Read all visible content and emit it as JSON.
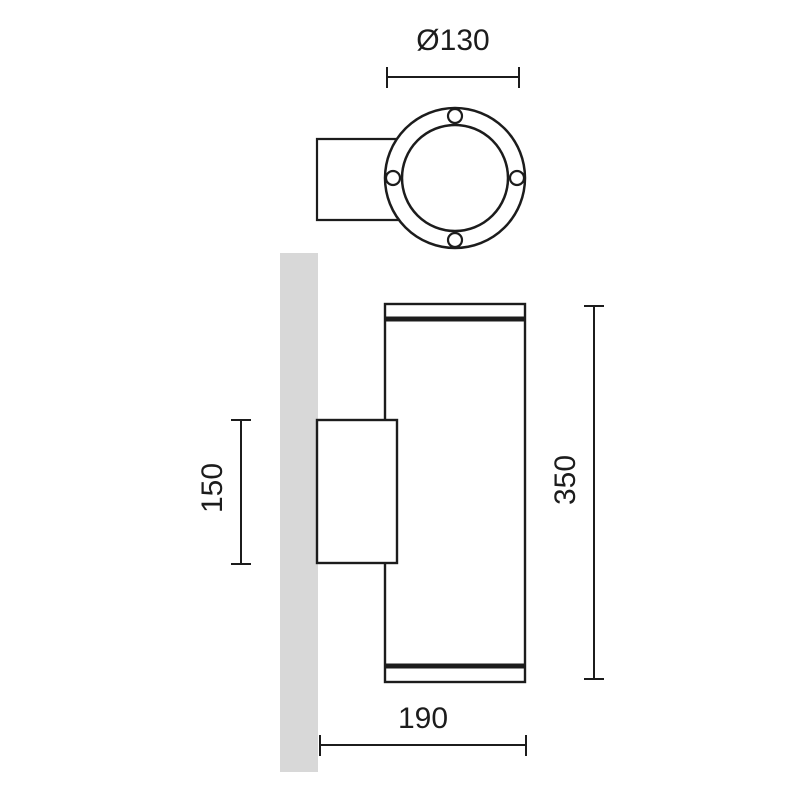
{
  "dimensions": {
    "flange_diameter": "Ø130",
    "bracket_height": "150",
    "body_height": "350",
    "body_depth": "190"
  },
  "views": {
    "top_view": {
      "screw_hole_count": 4
    },
    "front_view": {
      "parts": [
        "wall",
        "mounting-bracket",
        "cylindrical-body"
      ]
    }
  },
  "colors": {
    "line": "#1c1c1c",
    "wall_fill": "#d8d8d8",
    "background": "#ffffff"
  }
}
